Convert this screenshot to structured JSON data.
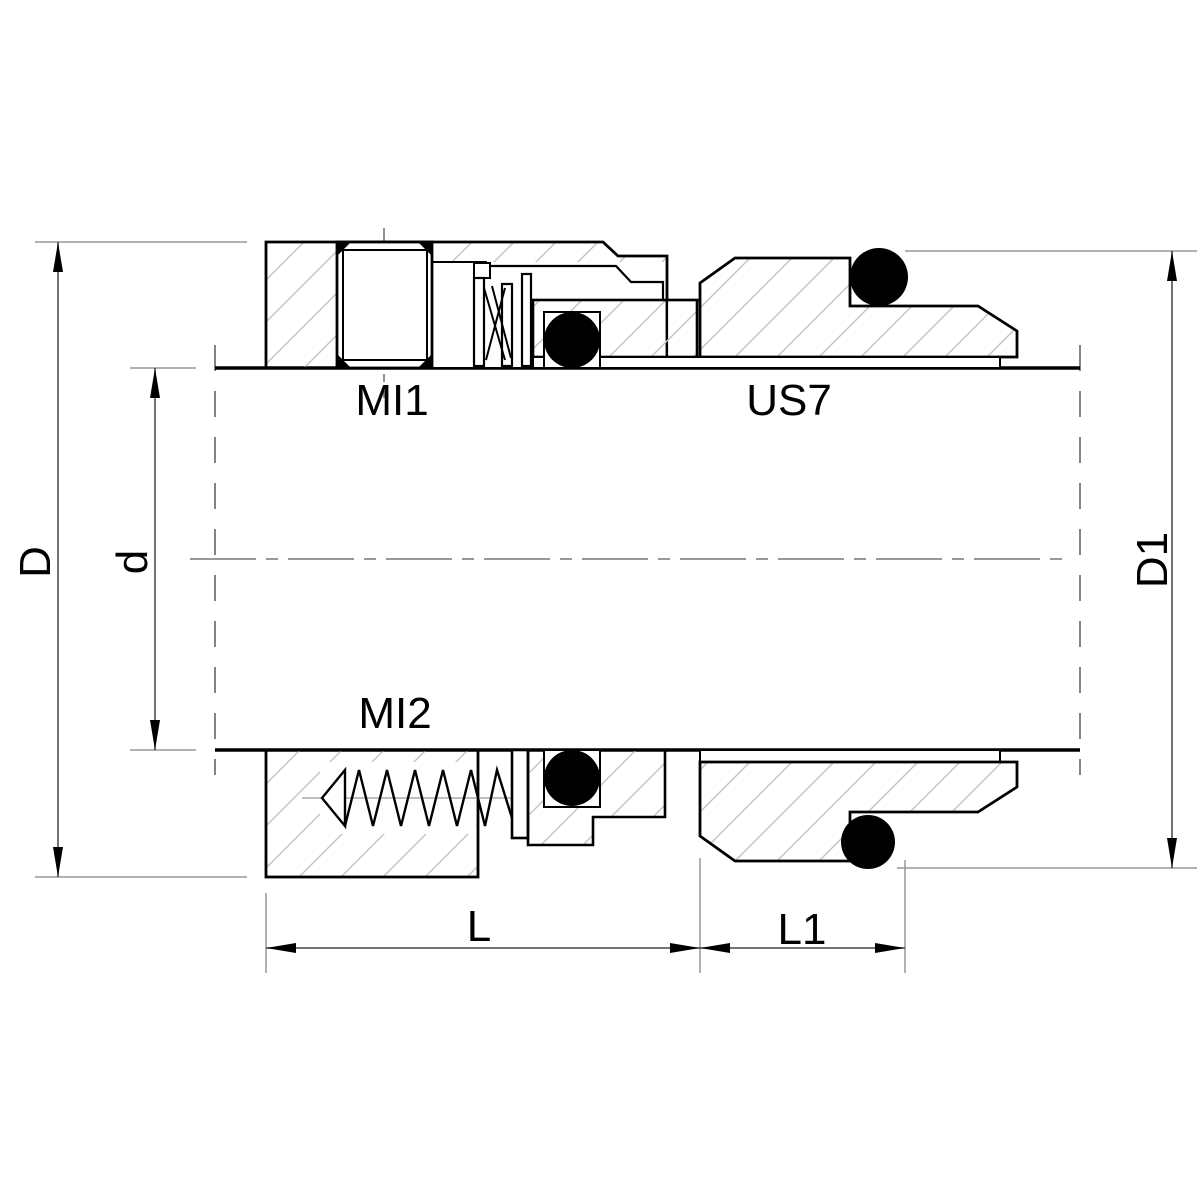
{
  "parts": {
    "mi1": "MI1",
    "us7": "US7",
    "mi2": "MI2"
  },
  "dimensions": {
    "outer_diameter": "D",
    "shaft_diameter": "d",
    "seat_diameter": "D1",
    "working_length": "L",
    "seat_length": "L1"
  },
  "colors": {
    "line": "#000000",
    "hatch": "#c4c4c4",
    "dim_line": "#444444",
    "ext_line": "#999999",
    "oring": "#000000",
    "background": "#ffffff"
  }
}
